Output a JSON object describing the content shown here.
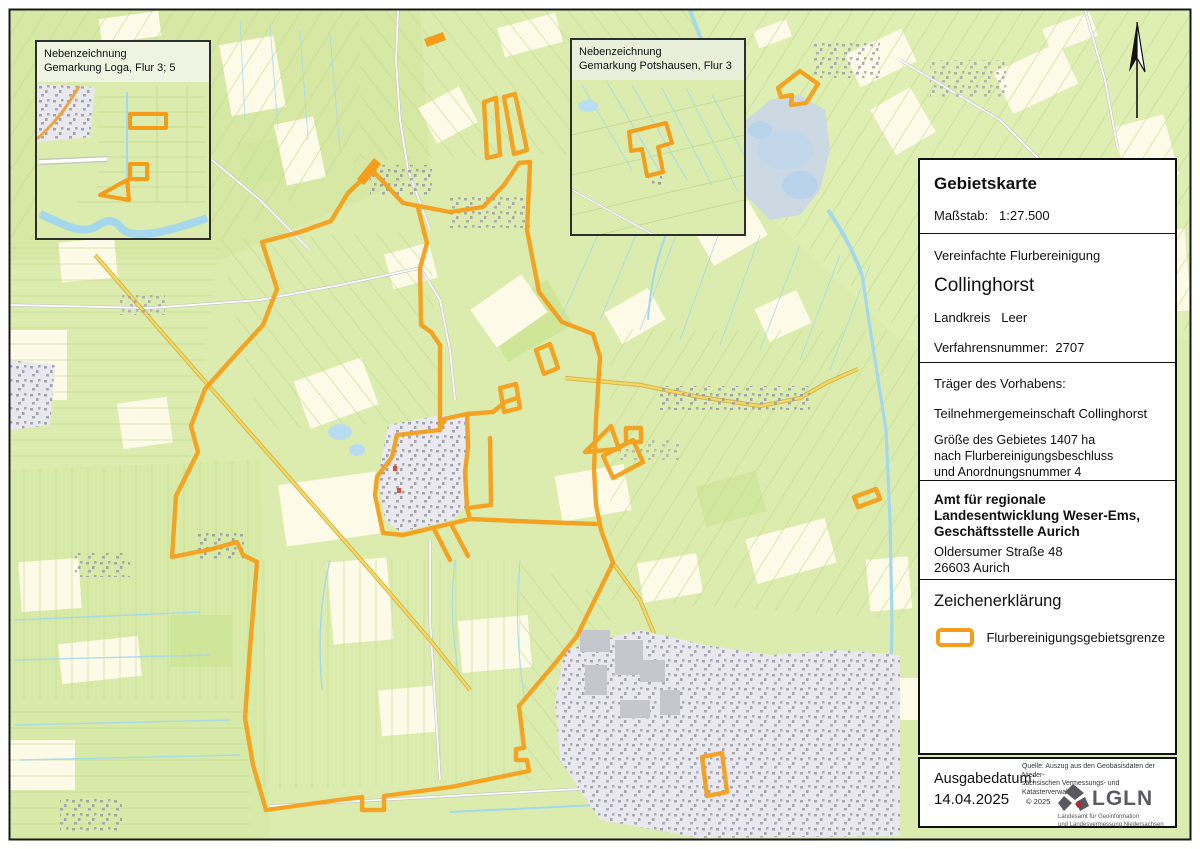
{
  "panel": {
    "title": "Gebietskarte",
    "scale_label": "Maßstab:",
    "scale_value": "1:27.500",
    "procedure_type": "Vereinfachte Flurbereinigung",
    "procedure_name": "Collinghorst",
    "district_label": "Landkreis",
    "district_value": "Leer",
    "number_label": "Verfahrensnummer:",
    "number_value": "2707",
    "carrier_heading": "Träger des Vorhabens:",
    "carrier_name": "Teilnehmergemeinschaft Collinghorst",
    "area_line1": "Größe des Gebietes 1407 ha",
    "area_line2": "nach Flurbereinigungsbeschluss",
    "area_line3": "und Anordnungsnummer 4",
    "office_line1": "Amt für regionale",
    "office_line2": "Landesentwicklung Weser-Ems,",
    "office_line3": "Geschäftsstelle Aurich",
    "office_street": "Oldersumer Straße 48",
    "office_city": "26603 Aurich",
    "legend_heading": "Zeichenerklärung",
    "legend_item": "Flurbereinigungsgebietsgrenze"
  },
  "footer": {
    "date_label": "Ausgabedatum:",
    "date_value": "14.04.2025",
    "source_line1": "Quelle: Auszug aus den Geobasisdaten der Nieder-",
    "source_line2": "sächsischen Vermessungs- und Katasterverwaltung",
    "copyright": "© 2025",
    "logo_text": "LGLN",
    "logo_sub1": "Landesamt für Geoinformation",
    "logo_sub2": "und Landesvermessung Niedersachsen"
  },
  "insets": [
    {
      "line1": "Nebenzeichnung",
      "line2": "Gemarkung Loga, Flur 3; 5"
    },
    {
      "line1": "Nebenzeichnung",
      "line2": "Gemarkung Potshausen, Flur 3"
    }
  ],
  "colors": {
    "boundary_orange": "#F59D18",
    "map_green": "#DCECAE",
    "map_cream": "#FDFBE8",
    "water_blue": "#A5D8EC",
    "road_yellow": "#F2D964",
    "settlement_grey": "#EAE9EF"
  }
}
